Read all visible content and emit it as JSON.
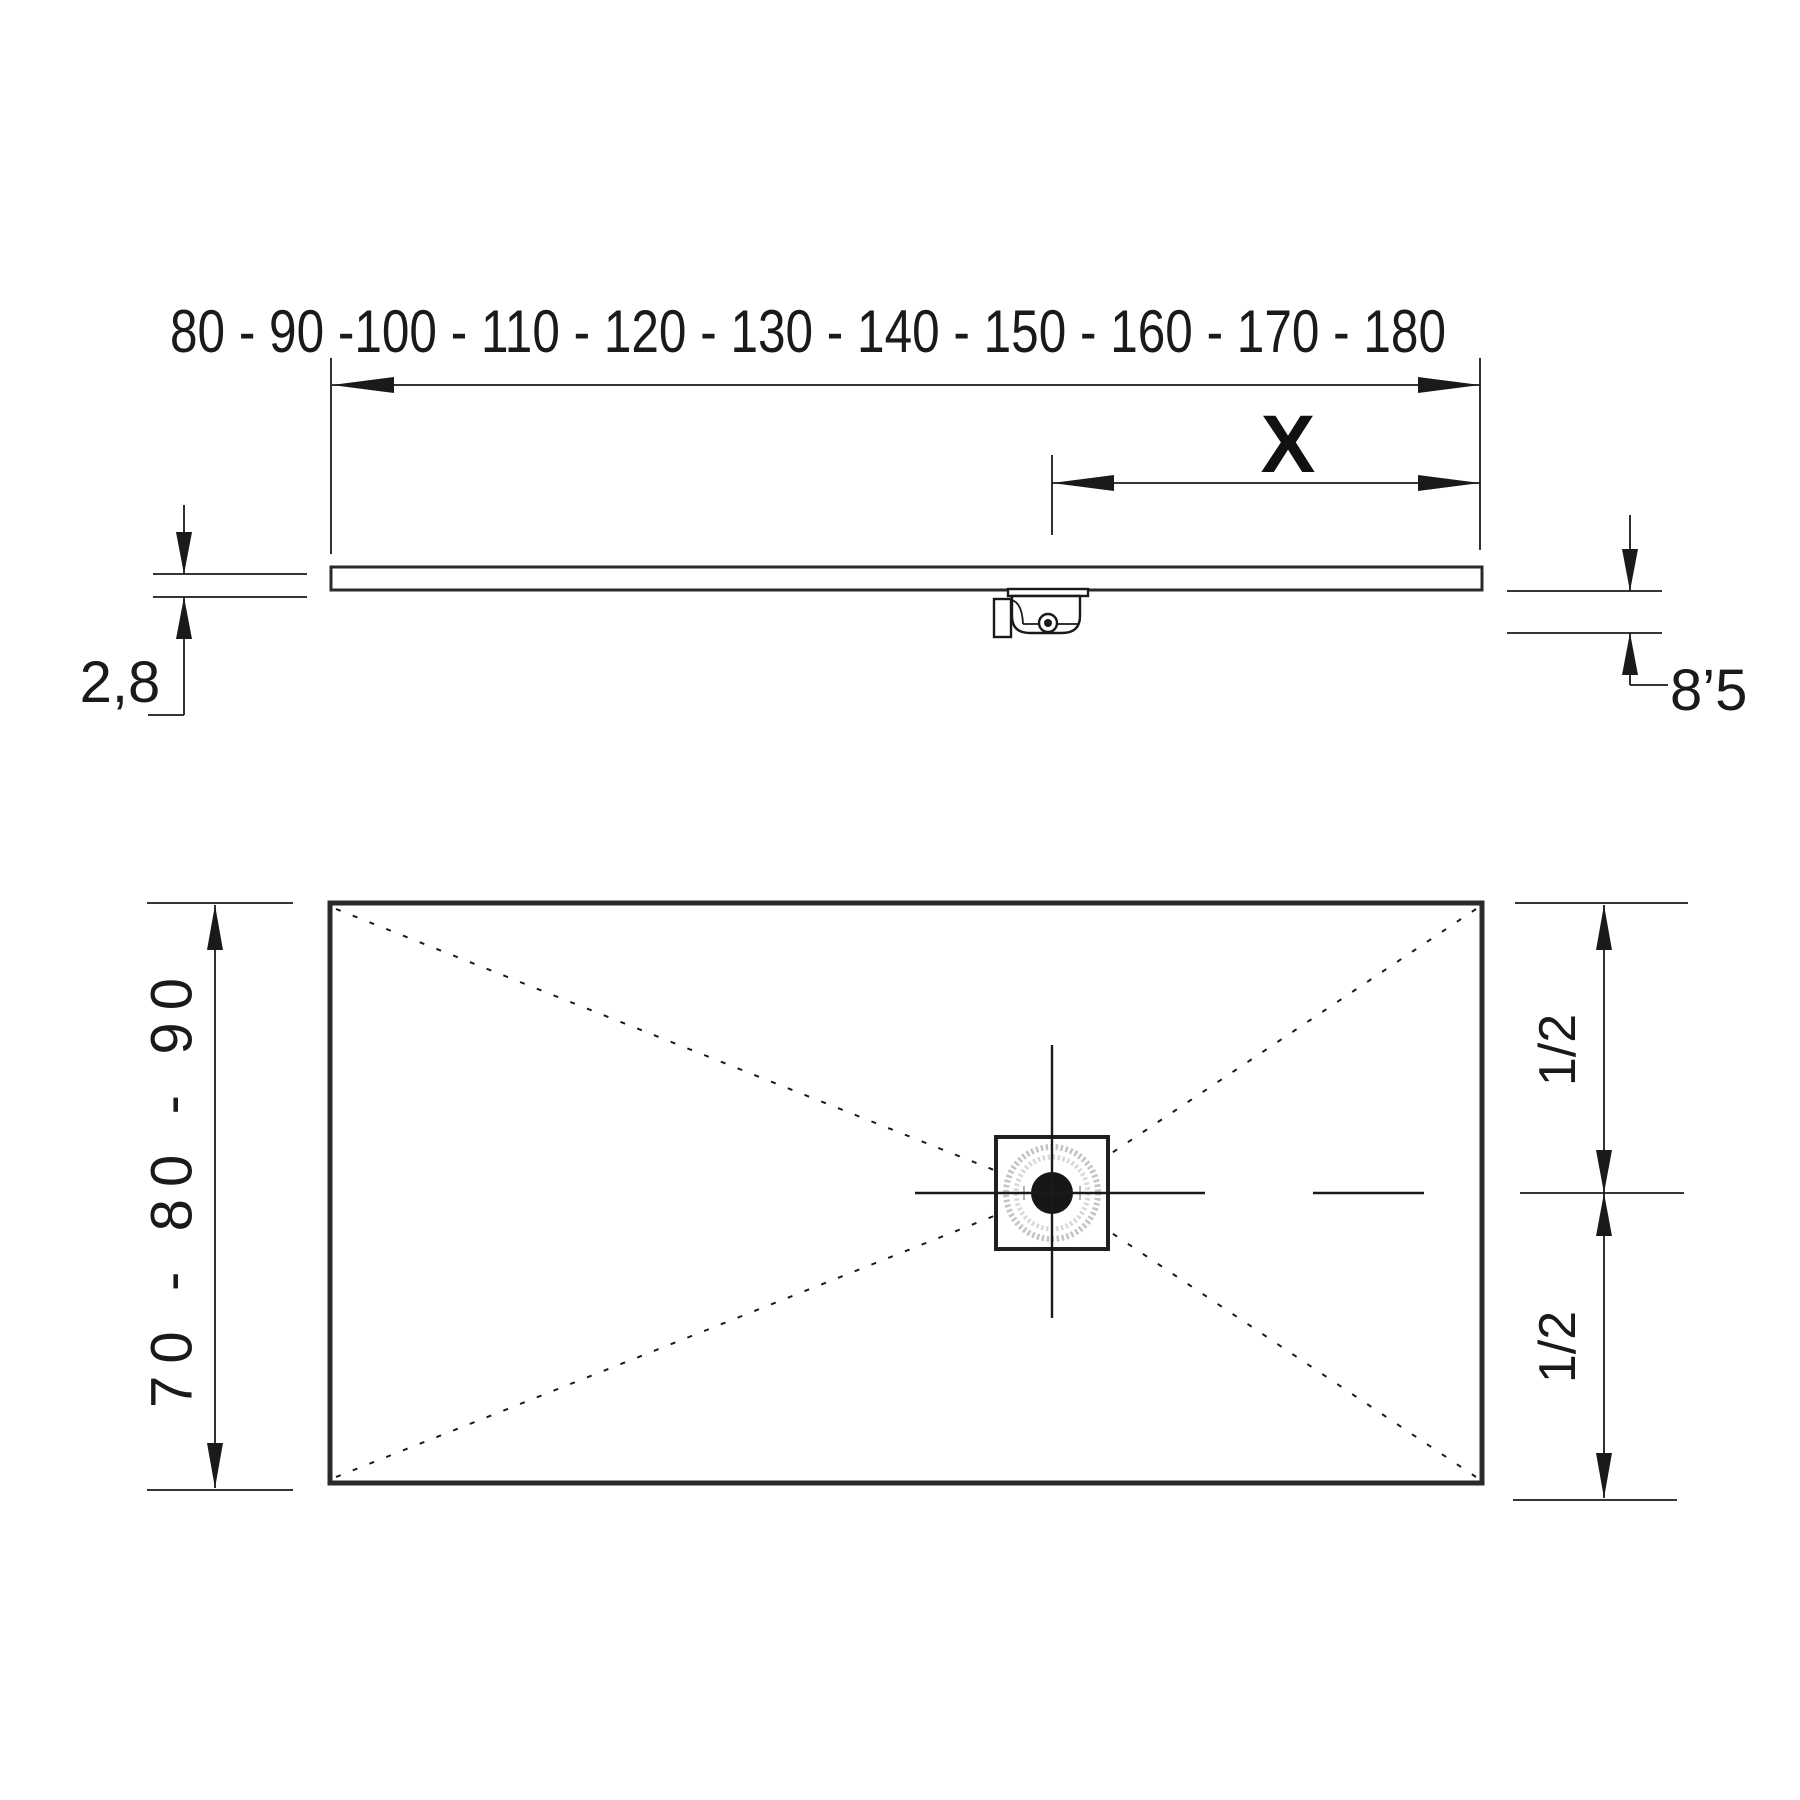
{
  "drawing": {
    "type": "shower-tray technical dimension drawing",
    "side_view": {
      "width_range_label": "80 - 90 -100 - 110 - 120 - 130 - 140 - 150 - 160 - 170 - 180",
      "x_label": "X",
      "thickness_label": "2,8",
      "height_label": "8’5"
    },
    "plan_view": {
      "depth_range_label": "70 - 80 - 90",
      "upper_half_label": "1/2",
      "lower_half_label": "1/2"
    }
  },
  "colors": {
    "line": "#1a1a1a",
    "outline": "#2a2a2a",
    "ring_outer": "#c4c4c4",
    "ring_inner": "#d8d8d8",
    "drain_dot": "#161616",
    "background": "#ffffff"
  }
}
